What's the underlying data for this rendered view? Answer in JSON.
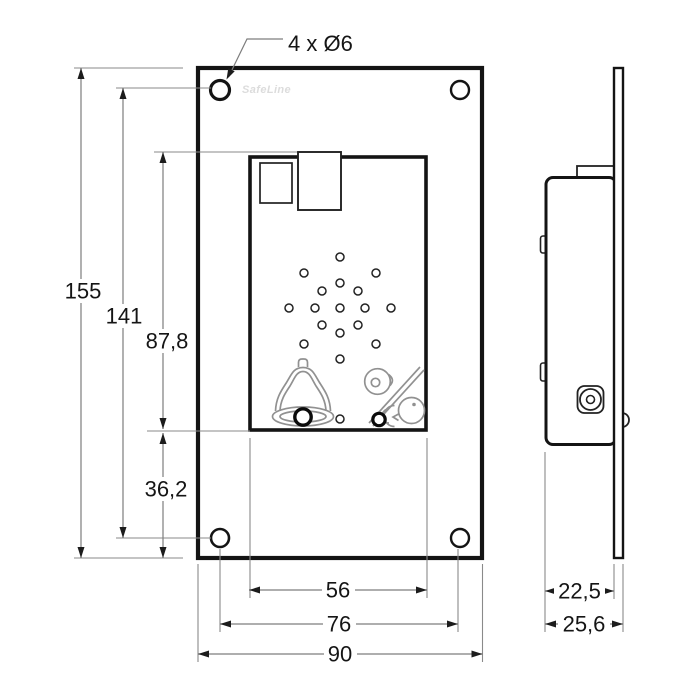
{
  "drawing": {
    "brand_watermark": "SafeLine",
    "hole_callout": "4 x Ø6",
    "dimensions": {
      "overall_height_mm": "155",
      "hole_pitch_vertical_mm": "141",
      "inner_unit_height_mm": "87,8",
      "inner_unit_bottom_offset_mm": "36,2",
      "inner_unit_width_mm": "56",
      "hole_pitch_horizontal_mm": "76",
      "overall_width_mm": "90",
      "enclosure_depth_mm": "22,5",
      "total_depth_mm": "25,6"
    },
    "icons": {
      "front_view": [
        "speaker-grille",
        "microphone-hole",
        "bell-icon",
        "intercom-pictogram"
      ],
      "indicators": [
        "alarm-button",
        "indicator-led"
      ]
    },
    "colors": {
      "outline": "#141414",
      "dimension_lines": "#7d7d7d",
      "icon_outline": "#919191",
      "watermark": "#dcdcdc",
      "background": "#ffffff"
    }
  }
}
